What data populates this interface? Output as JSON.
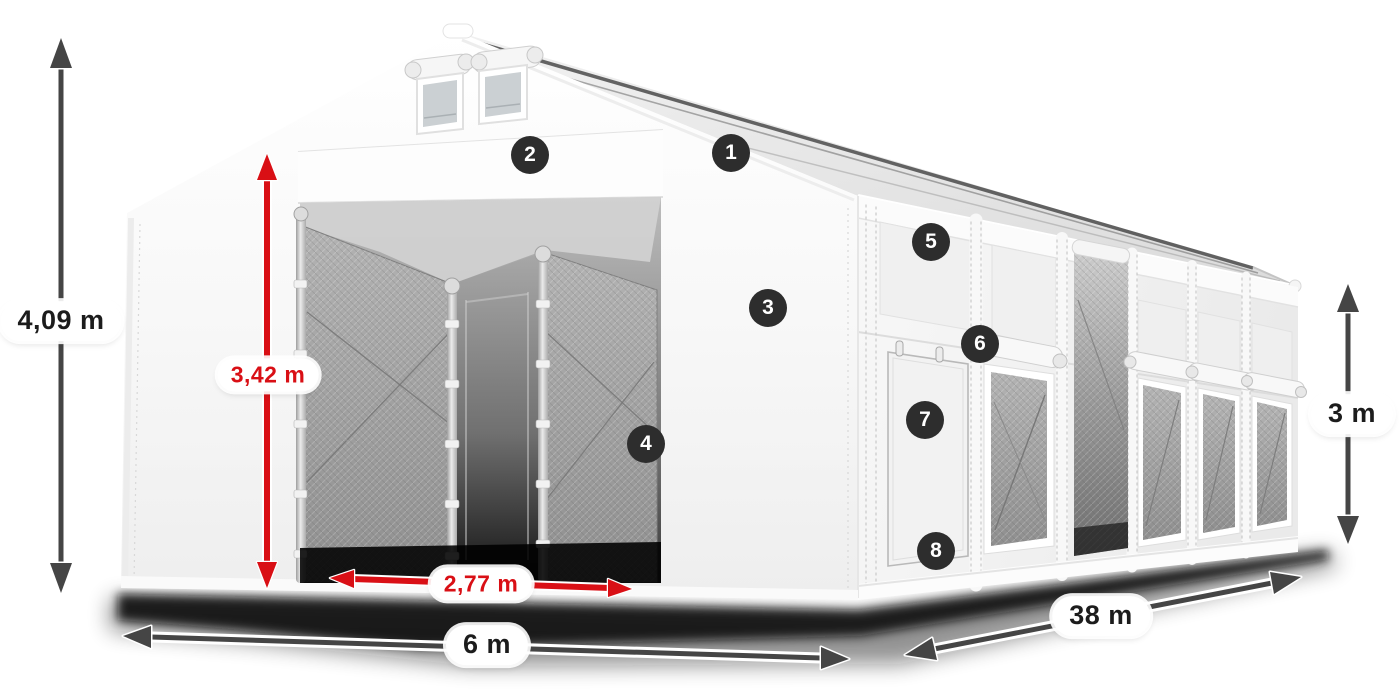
{
  "figure": {
    "colors": {
      "dimension_red": "#d90f15",
      "dimension_dark": "#454545",
      "marker_background": "#2d2d2d",
      "marker_text": "#ffffff",
      "label_background": "#ffffff",
      "label_text_dark": "#1c1c1c"
    },
    "dimensions": {
      "total_height": "4,09 m",
      "entrance_height": "3,42 m",
      "entrance_width": "2,77 m",
      "front_width": "6 m",
      "length": "38 m",
      "side_wall_height": "3 m"
    },
    "markers": [
      "1",
      "2",
      "3",
      "4",
      "5",
      "6",
      "7",
      "8"
    ]
  }
}
